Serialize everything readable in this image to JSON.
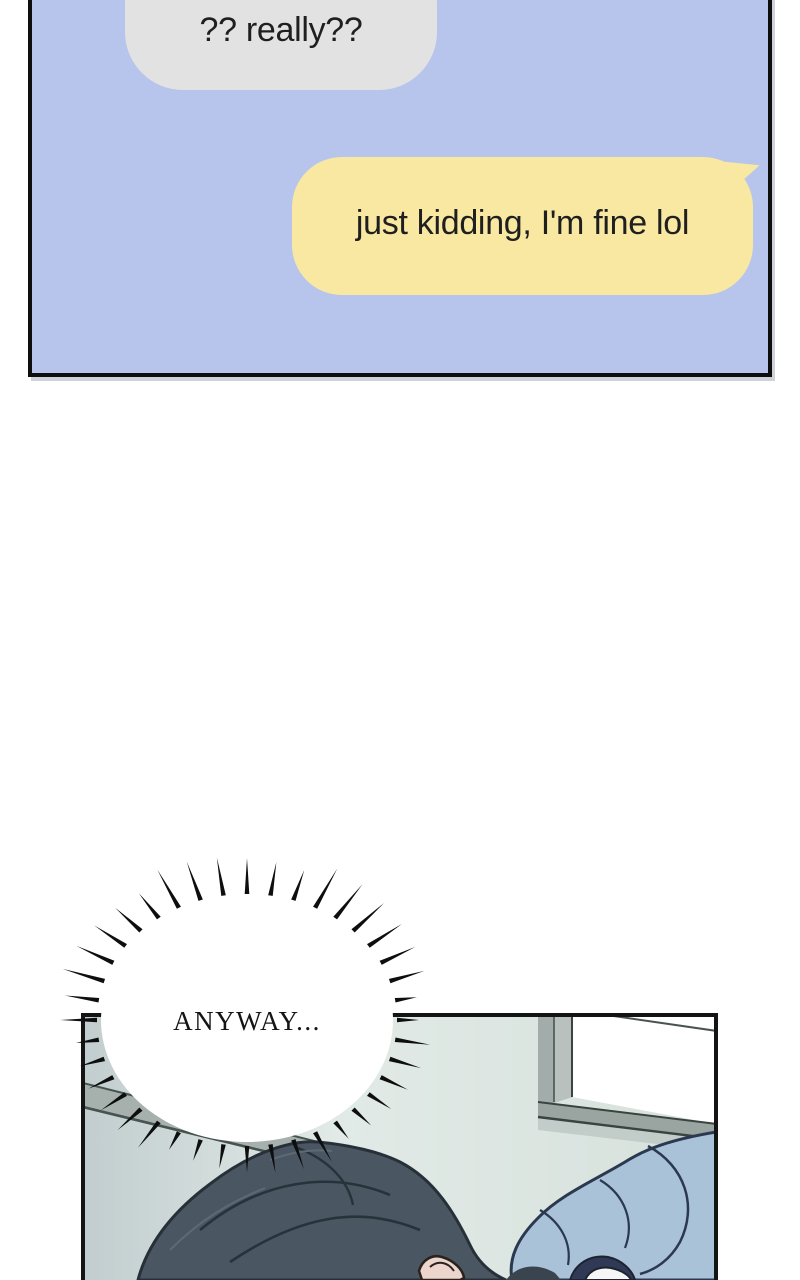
{
  "page": {
    "background": "#ffffff"
  },
  "chat_panel": {
    "background": "#b7c5ec",
    "border_color": "#0e0e0e",
    "text_color": "#1f1f1f",
    "messages": [
      {
        "sender": "other",
        "text": "?? really??",
        "bubble_color": "#e2e2e2"
      },
      {
        "sender": "self",
        "text": "just kidding, I'm fine lol",
        "bubble_color": "#f8e8a1"
      }
    ]
  },
  "scene_panel": {
    "burst_text": "ANYWAY...",
    "palette": {
      "wall_left": "#c2cdcf",
      "wall_light": "#e1eae6",
      "wall_right": "#d7e1dc",
      "rail": "#a6b1ae",
      "rail_line": "#47534f",
      "window_frame": "#a2acaa",
      "window_frame_light": "#b8c1be",
      "window_pane": "#ffffff",
      "window_line": "#49544f",
      "sill": "#9aa5a2",
      "sill_light": "#c2ccc8",
      "hair": "#4a5662",
      "hair_dark": "#39444e",
      "hair_line": "#273039",
      "ear": "#ecd5cc",
      "ear_line": "#2a231d",
      "blanket": "#a9c2d8",
      "blanket_line": "#2b3950",
      "accent_navy": "#303a56",
      "accent_white": "#f6f6f6",
      "panel_border": "#141414",
      "burst_ink": "#0e0e0e",
      "burst_fill": "#ffffff"
    }
  }
}
